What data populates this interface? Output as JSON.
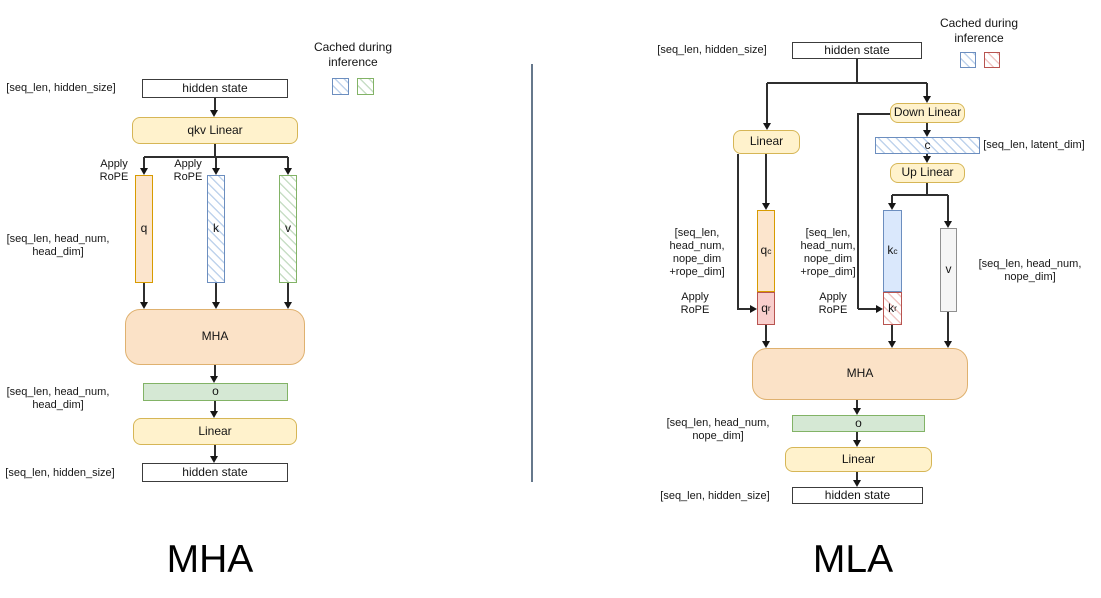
{
  "mha": {
    "title": "MHA",
    "legend": {
      "title": "Cached during inference"
    },
    "nodes": {
      "hidden_in": "hidden state",
      "qkv_linear": "qkv Linear",
      "q": "q",
      "k": "k",
      "v": "v",
      "attention": "MHA",
      "o": "o",
      "out_linear": "Linear",
      "hidden_out": "hidden state"
    },
    "labels": {
      "input_shape": "[seq_len, hidden_size]",
      "apply_rope": "Apply RoPE",
      "qkv_shape": "[seq_len, head_num, head_dim]",
      "o_shape": "[seq_len, head_num, head_dim]",
      "output_shape": "[seq_len, hidden_size]"
    }
  },
  "mla": {
    "title": "MLA",
    "legend": {
      "title": "Cached during inference"
    },
    "nodes": {
      "hidden_in": "hidden state",
      "q_linear": "Linear",
      "down_linear": "Down Linear",
      "c": "c",
      "up_linear": "Up Linear",
      "q_c": {
        "base": "q",
        "sub": "c"
      },
      "q_r": {
        "base": "q",
        "sub": "r"
      },
      "k_c": {
        "base": "k",
        "sub": "c"
      },
      "k_r": {
        "base": "k",
        "sub": "r"
      },
      "v": "v",
      "attention": "MHA",
      "o": "o",
      "out_linear": "Linear",
      "hidden_out": "hidden state"
    },
    "labels": {
      "input_shape": "[seq_len, hidden_size]",
      "latent_shape": "[seq_len, latent_dim]",
      "q_shape": "[seq_len, head_num, nope_dim +rope_dim]",
      "k_shape": "[seq_len, head_num, nope_dim +rope_dim]",
      "v_shape": "[seq_len, head_num, nope_dim]",
      "apply_rope": "Apply RoPE",
      "o_shape": "[seq_len, head_num, nope_dim]",
      "output_shape": "[seq_len, hidden_size]"
    }
  },
  "colors": {
    "yellow_fill": "#fff2cc",
    "yellow_stroke": "#d6b656",
    "orange_fill": "#fce5cd",
    "orange_stroke": "#d79b00",
    "attn_fill": "#fbe2c7",
    "attn_stroke": "#dfb16f",
    "green_fill": "#d5e8d4",
    "green_stroke": "#82b366",
    "blue_fill": "#dae8fc",
    "blue_stroke": "#6c8ebf",
    "red_fill": "#f8cecc",
    "red_stroke": "#b85450",
    "gray_fill": "#f5f5f5",
    "gray_stroke": "#909090",
    "divider": "#66788c"
  }
}
